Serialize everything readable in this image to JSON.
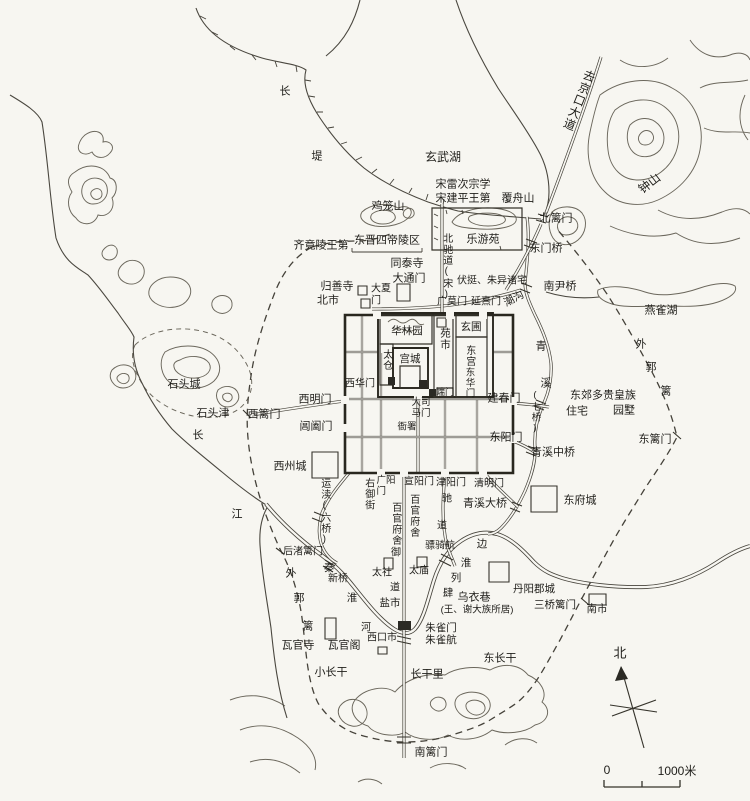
{
  "map": {
    "compass": {
      "north": "北"
    },
    "scale_bar": {
      "zero": "0",
      "max_label": "1000米"
    },
    "labels": [
      {
        "id": "dike-chang",
        "text": "长",
        "x": 285,
        "y": 92
      },
      {
        "id": "dike-di",
        "text": "堤",
        "x": 317,
        "y": 157
      },
      {
        "id": "xuanwu-lake",
        "text": "玄武湖",
        "x": 443,
        "y": 158,
        "fs": 12
      },
      {
        "id": "song-leicizong-school",
        "text": "宋雷次宗学",
        "x": 463,
        "y": 185
      },
      {
        "id": "song-jianping-residence",
        "text": "宋建平王第",
        "x": 463,
        "y": 199
      },
      {
        "id": "fuzhou-mountain",
        "text": "覆舟山",
        "x": 518,
        "y": 199
      },
      {
        "id": "jilong-mountain",
        "text": "鸡笼山",
        "x": 388,
        "y": 207
      },
      {
        "id": "beili-gate",
        "text": "北篱门",
        "x": 556,
        "y": 219
      },
      {
        "id": "jingkou-road",
        "text": "去京口大道",
        "x": 578,
        "y": 100,
        "dir": "v",
        "rot": 22,
        "fs": 12
      },
      {
        "id": "zhong-mountain",
        "text": "钟山",
        "x": 650,
        "y": 184,
        "rot": -38,
        "fs": 12
      },
      {
        "id": "qi-jingling-residence",
        "text": "齐竟陵王第",
        "x": 321,
        "y": 246
      },
      {
        "id": "dongjin-tombs",
        "text": "东晋四帝陵区",
        "x": 387,
        "y": 241
      },
      {
        "id": "leyou-garden",
        "text": "乐游苑",
        "x": 483,
        "y": 240
      },
      {
        "id": "dongmen-bridge",
        "text": "东门桥",
        "x": 546,
        "y": 249
      },
      {
        "id": "tongtai-temple",
        "text": "同泰寺",
        "x": 407,
        "y": 264
      },
      {
        "id": "datong-gate",
        "text": "大通门",
        "x": 409,
        "y": 279
      },
      {
        "id": "north-chidao",
        "text": "北驰道(宋)",
        "x": 446,
        "y": 267,
        "dir": "v",
        "fs": 10
      },
      {
        "id": "futing-zhuyi-residences",
        "text": "伏挺、朱异诸宅",
        "x": 492,
        "y": 281,
        "fs": 10
      },
      {
        "id": "nanyin-bridge",
        "text": "南尹桥",
        "x": 560,
        "y": 287
      },
      {
        "id": "guishan-temple",
        "text": "归善寺",
        "x": 337,
        "y": 287
      },
      {
        "id": "north-market",
        "text": "北市",
        "x": 328,
        "y": 301
      },
      {
        "id": "daxia-gate",
        "text": "大夏\n门",
        "x": 381,
        "y": 295,
        "pre": true,
        "fs": 10
      },
      {
        "id": "guangmo-gate",
        "text": "广莫门",
        "x": 452,
        "y": 302,
        "fs": 10
      },
      {
        "id": "yanxi-gate",
        "text": "延熹门",
        "x": 486,
        "y": 302,
        "fs": 10
      },
      {
        "id": "chaogou-channel",
        "text": "潮沟",
        "x": 514,
        "y": 299,
        "rot": -28,
        "fs": 10.5
      },
      {
        "id": "hualin-garden",
        "text": "华林园",
        "x": 407,
        "y": 331,
        "fs": 10.5
      },
      {
        "id": "yuan-market",
        "text": "苑市",
        "x": 445,
        "y": 339,
        "dir": "v",
        "fs": 10.5
      },
      {
        "id": "xuanpu-garden",
        "text": "玄圃",
        "x": 471,
        "y": 327,
        "fs": 10.5
      },
      {
        "id": "taicang-granary",
        "text": "太仓",
        "x": 386,
        "y": 360,
        "dir": "v",
        "fs": 10
      },
      {
        "id": "gongcheng-palace",
        "text": "宫城",
        "x": 410,
        "y": 359,
        "fs": 10.5
      },
      {
        "id": "east-palace",
        "text": "东宫",
        "x": 469,
        "y": 356,
        "dir": "v",
        "fs": 10
      },
      {
        "id": "donghua-gate",
        "text": "东华门",
        "x": 468,
        "y": 383,
        "dir": "v",
        "fs": 9.5
      },
      {
        "id": "xihua-gate",
        "text": "西华门",
        "x": 360,
        "y": 384,
        "fs": 10
      },
      {
        "id": "duan-gate",
        "text": "端门",
        "x": 445,
        "y": 392,
        "fs": 9
      },
      {
        "id": "ximing-gate",
        "text": "西明门",
        "x": 315,
        "y": 400
      },
      {
        "id": "jianchun-gate",
        "text": "建春门",
        "x": 504,
        "y": 399
      },
      {
        "id": "qingxi-qing",
        "text": "青",
        "x": 541,
        "y": 347
      },
      {
        "id": "qingxi-xi",
        "text": "溪",
        "x": 546,
        "y": 384
      },
      {
        "id": "seven-bridges",
        "text": "(七桥)",
        "x": 534,
        "y": 412,
        "dir": "v",
        "fs": 9.5
      },
      {
        "id": "changhe-gate",
        "text": "阊阖门",
        "x": 316,
        "y": 427
      },
      {
        "id": "dongyang-gate",
        "text": "东阳门",
        "x": 506,
        "y": 438
      },
      {
        "id": "east-suburb-note",
        "text": "东郊多贵皇族",
        "x": 603,
        "y": 396
      },
      {
        "id": "east-suburb-zhuzhai",
        "text": "住宅",
        "x": 577,
        "y": 412
      },
      {
        "id": "east-suburb-yuanshu",
        "text": "园墅",
        "x": 624,
        "y": 411
      },
      {
        "id": "outer-fence-east-wai",
        "text": "外",
        "x": 641,
        "y": 345
      },
      {
        "id": "outer-fence-east-guo",
        "text": "郭",
        "x": 651,
        "y": 368
      },
      {
        "id": "outer-fence-east-li",
        "text": "篱",
        "x": 666,
        "y": 392
      },
      {
        "id": "dongli-gate",
        "text": "东篱门",
        "x": 655,
        "y": 440
      },
      {
        "id": "shitou-city",
        "text": "石头城",
        "x": 184,
        "y": 385
      },
      {
        "id": "shitou-ferry",
        "text": "石头津",
        "x": 213,
        "y": 414
      },
      {
        "id": "xili-gate",
        "text": "西篱门",
        "x": 264,
        "y": 415
      },
      {
        "id": "yangtze-chang",
        "text": "长",
        "x": 198,
        "y": 436
      },
      {
        "id": "yangtze-jiang",
        "text": "江",
        "x": 237,
        "y": 515
      },
      {
        "id": "xizhou-city",
        "text": "西州城",
        "x": 290,
        "y": 467
      },
      {
        "id": "yundu-canal",
        "text": "运渎(六桥)",
        "x": 324,
        "y": 512,
        "dir": "v",
        "fs": 10
      },
      {
        "id": "right-imperial-street",
        "text": "右御街",
        "x": 368,
        "y": 494,
        "dir": "v",
        "fs": 10
      },
      {
        "id": "guangyang-gate",
        "text": "广阳\n门",
        "x": 386,
        "y": 487,
        "pre": true,
        "fs": 9.5
      },
      {
        "id": "xuanyang-gate",
        "text": "宣阳门",
        "x": 419,
        "y": 482,
        "fs": 10
      },
      {
        "id": "jinyang-gate",
        "text": "津阳门",
        "x": 451,
        "y": 483,
        "fs": 10
      },
      {
        "id": "qingming-gate",
        "text": "清明门",
        "x": 489,
        "y": 484,
        "fs": 10
      },
      {
        "id": "dasima-gate",
        "text": "大司\n马门",
        "x": 421,
        "y": 409,
        "pre": true,
        "fs": 9.5
      },
      {
        "id": "yamen-offices",
        "text": "衙署",
        "x": 407,
        "y": 428,
        "fs": 9.5
      },
      {
        "id": "qingxi-middle-bridge",
        "text": "青溪中桥",
        "x": 553,
        "y": 453
      },
      {
        "id": "qingxi-great-bridge",
        "text": "青溪大桥",
        "x": 485,
        "y": 504
      },
      {
        "id": "dongfu-city",
        "text": "东府城",
        "x": 580,
        "y": 501
      },
      {
        "id": "officials-quarters-west",
        "text": "百官府舍",
        "x": 395,
        "y": 524,
        "dir": "v",
        "fs": 10
      },
      {
        "id": "officials-quarters-east",
        "text": "百官府舍",
        "x": 413,
        "y": 516,
        "dir": "v",
        "fs": 10
      },
      {
        "id": "imperial-road-yu",
        "text": "御",
        "x": 396,
        "y": 553,
        "fs": 10
      },
      {
        "id": "imperial-road-dao",
        "text": "道",
        "x": 395,
        "y": 588,
        "fs": 10
      },
      {
        "id": "chidao-chi",
        "text": "驰",
        "x": 447,
        "y": 499,
        "fs": 10
      },
      {
        "id": "chidao-dao",
        "text": "道",
        "x": 442,
        "y": 526,
        "fs": 10
      },
      {
        "id": "piaoqi-ferry",
        "text": "骠骑航",
        "x": 440,
        "y": 546,
        "fs": 10
      },
      {
        "id": "riverside-bian",
        "text": "边",
        "x": 482,
        "y": 544,
        "fs": 10.5
      },
      {
        "id": "riverside-huai",
        "text": "淮",
        "x": 466,
        "y": 563,
        "fs": 10.5
      },
      {
        "id": "riverside-lie",
        "text": "列",
        "x": 456,
        "y": 578,
        "fs": 10.5
      },
      {
        "id": "riverside-si",
        "text": "肆",
        "x": 448,
        "y": 593,
        "fs": 10.5
      },
      {
        "id": "wuyi-lane",
        "text": "乌衣巷",
        "x": 474,
        "y": 598
      },
      {
        "id": "wuyi-lane-note",
        "text": "(王、谢大族所居)",
        "x": 477,
        "y": 611,
        "fs": 9.5
      },
      {
        "id": "taishe-altar",
        "text": "太社",
        "x": 382,
        "y": 573,
        "fs": 10
      },
      {
        "id": "taimiao-temple",
        "text": "太庙",
        "x": 419,
        "y": 571,
        "fs": 10
      },
      {
        "id": "salt-market",
        "text": "盐市",
        "x": 390,
        "y": 603,
        "fs": 10.5
      },
      {
        "id": "qinhuai-qin",
        "text": "秦",
        "x": 329,
        "y": 568,
        "fs": 10.5
      },
      {
        "id": "xin-bridge",
        "text": "新桥",
        "x": 338,
        "y": 579,
        "fs": 10
      },
      {
        "id": "qinhuai-huai",
        "text": "淮",
        "x": 352,
        "y": 598,
        "fs": 10.5
      },
      {
        "id": "houzhuli-gate",
        "text": "后渚篱门",
        "x": 303,
        "y": 552,
        "fs": 10
      },
      {
        "id": "outer-fence-west-wai",
        "text": "外",
        "x": 291,
        "y": 574
      },
      {
        "id": "outer-fence-west-guo",
        "text": "郭",
        "x": 299,
        "y": 599
      },
      {
        "id": "outer-fence-west-li",
        "text": "篱",
        "x": 308,
        "y": 627
      },
      {
        "id": "waguan-temple",
        "text": "瓦官寺",
        "x": 298,
        "y": 646
      },
      {
        "id": "waguan-pavilion",
        "text": "瓦官阁",
        "x": 344,
        "y": 646
      },
      {
        "id": "he-river-char",
        "text": "河",
        "x": 366,
        "y": 628,
        "fs": 10
      },
      {
        "id": "xikou-market",
        "text": "西口市",
        "x": 382,
        "y": 638,
        "fs": 10
      },
      {
        "id": "zhuque-gate",
        "text": "朱雀门",
        "x": 441,
        "y": 628,
        "fs": 10.5
      },
      {
        "id": "zhuque-ferry",
        "text": "朱雀航",
        "x": 441,
        "y": 640,
        "fs": 10.5
      },
      {
        "id": "xiao-changgan",
        "text": "小长干",
        "x": 331,
        "y": 673
      },
      {
        "id": "changgan-li",
        "text": "长干里",
        "x": 427,
        "y": 675
      },
      {
        "id": "dong-changgan",
        "text": "东长干",
        "x": 500,
        "y": 659
      },
      {
        "id": "danyang-commandery",
        "text": "丹阳郡城",
        "x": 534,
        "y": 589,
        "fs": 10.5
      },
      {
        "id": "sanqiaoli-gate",
        "text": "三桥篱门",
        "x": 555,
        "y": 605,
        "fs": 10.5
      },
      {
        "id": "south-market",
        "text": "南市",
        "x": 597,
        "y": 609,
        "fs": 10.5
      },
      {
        "id": "nanli-gate",
        "text": "南篱门",
        "x": 431,
        "y": 753
      },
      {
        "id": "yanque-lake",
        "text": "燕雀湖",
        "x": 661,
        "y": 311
      }
    ]
  }
}
